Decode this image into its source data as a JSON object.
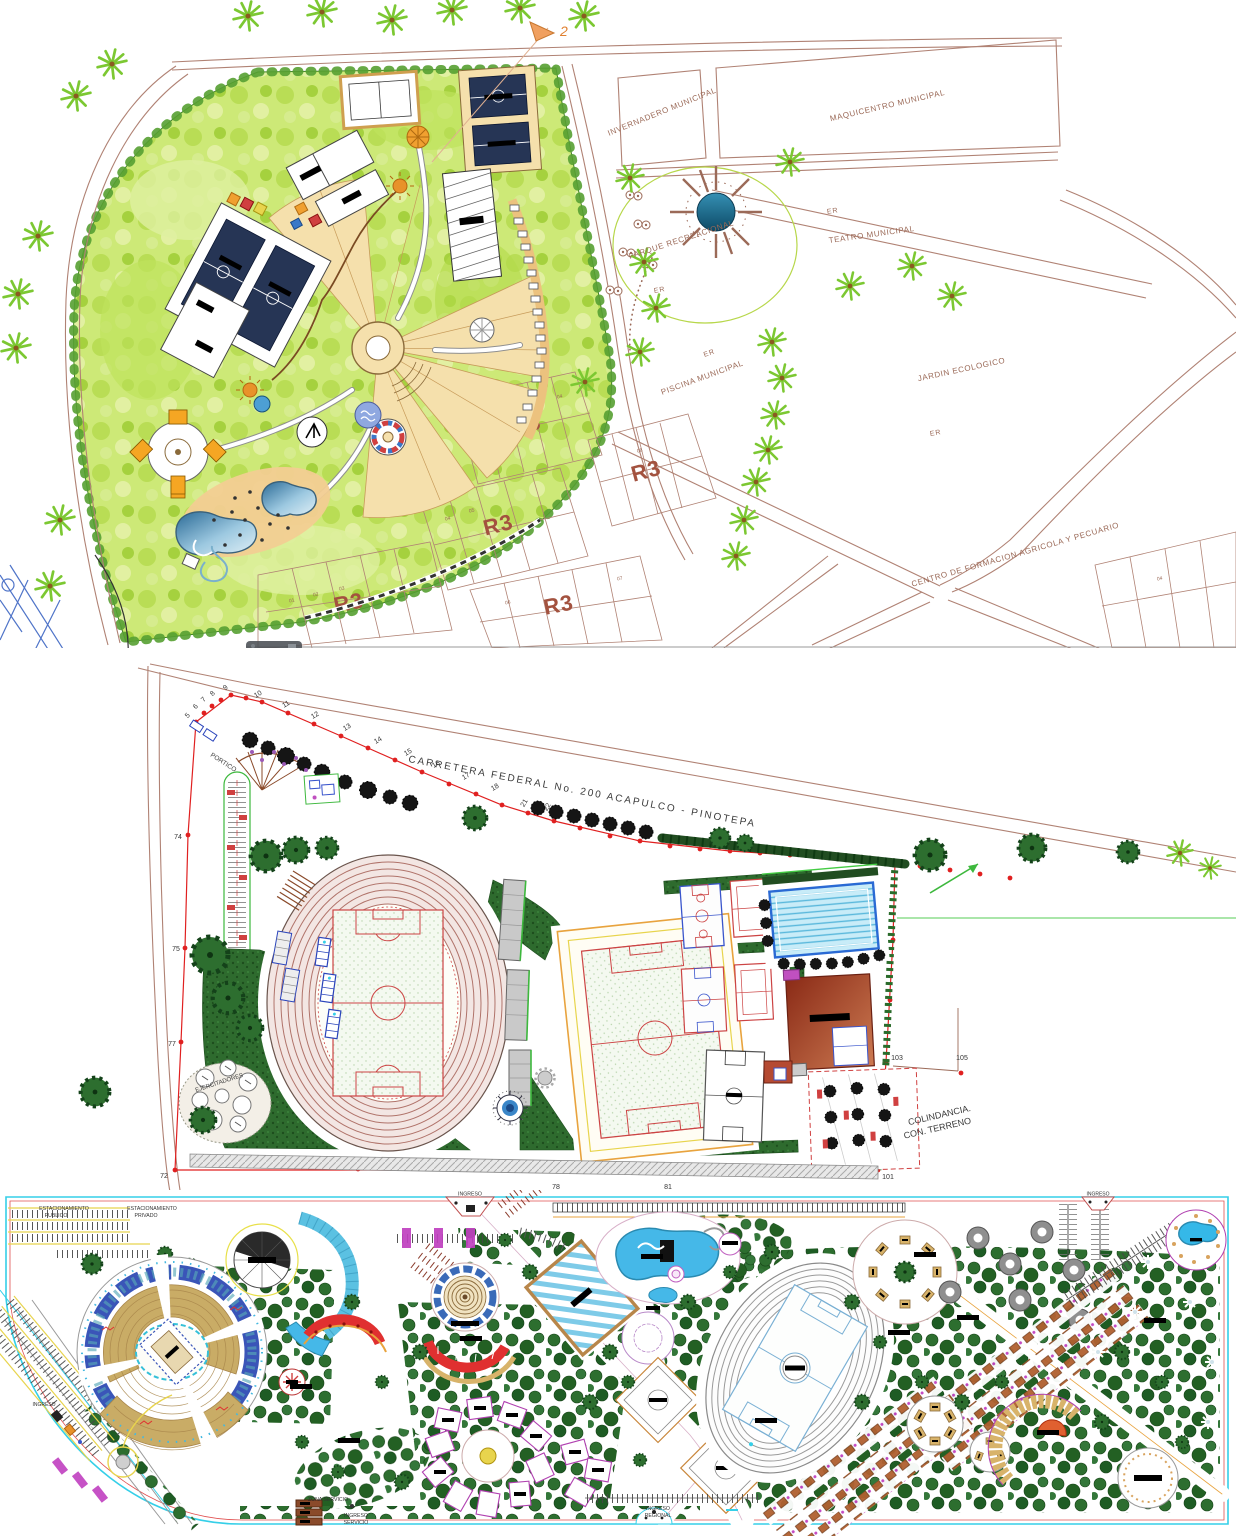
{
  "palette": {
    "road_brown": "#b08274",
    "label_brown": "#9b6a58",
    "r3_red": "#a3523f",
    "park_green": "#cde977",
    "tree_green": "#2d6e2f",
    "boundary_red": "#e02020",
    "water_blue": "#45b8e8",
    "track_brown": "#b0736a",
    "lawn_green": "#2e6b2e",
    "plan_border_cyan": "#35cfe8",
    "seating_tan": "#d8b36a"
  },
  "top_plan": {
    "street_labels": {
      "invernadero": "INVERNADERO MUNICIPAL",
      "maquicentro": "MAQUICENTRO MUNICIPAL",
      "teatro": "TEATRO MUNICIPAL",
      "piscina": "PISCINA MUNICIPAL",
      "jardin": "JARDIN ECOLOGICO",
      "centro_formacion": "CENTRO DE FORMACION AGRICOLA Y PECUARIO",
      "parque_recreacional": "PARQUE RECREACIONAL"
    },
    "er": "ER",
    "r3": "R3",
    "north_ref": "2",
    "lot_numbers": [
      "01",
      "02",
      "03",
      "04",
      "05",
      "06",
      "07",
      "08"
    ]
  },
  "middle_plan": {
    "highway_label": "CARRETERA FEDERAL No. 200  ACAPULCO - PINOTEPA",
    "portico": "PORTICO",
    "ejercitadores": "EJERCITADORES",
    "colindancia": [
      "COLINDANCIA.",
      "CON. TERRENO"
    ],
    "boundary_points_top": [
      "5",
      "6",
      "7",
      "8",
      "9",
      "10",
      "11",
      "12",
      "13",
      "14",
      "15",
      "16",
      "17",
      "18",
      "21",
      "22"
    ],
    "boundary_points_sides": [
      "74",
      "75",
      "77",
      "72",
      "76",
      "78",
      "81",
      "101",
      "103",
      "105"
    ]
  },
  "bottom_plan": {
    "labels": {
      "estacionamiento_publico": [
        "ESTACIONAMIENTO",
        "PUBLICO"
      ],
      "estacionamiento_privado": [
        "ESTACIONAMIENTO",
        "PRIVADO"
      ],
      "ingreso": "INGRESO",
      "zona_servicio": "ZONA SERVICIO",
      "ingreso_servicio": [
        "INGRESO",
        "SERVICIO"
      ],
      "ingreso_regional": [
        "INGRESO",
        "REGIONAL"
      ]
    }
  }
}
